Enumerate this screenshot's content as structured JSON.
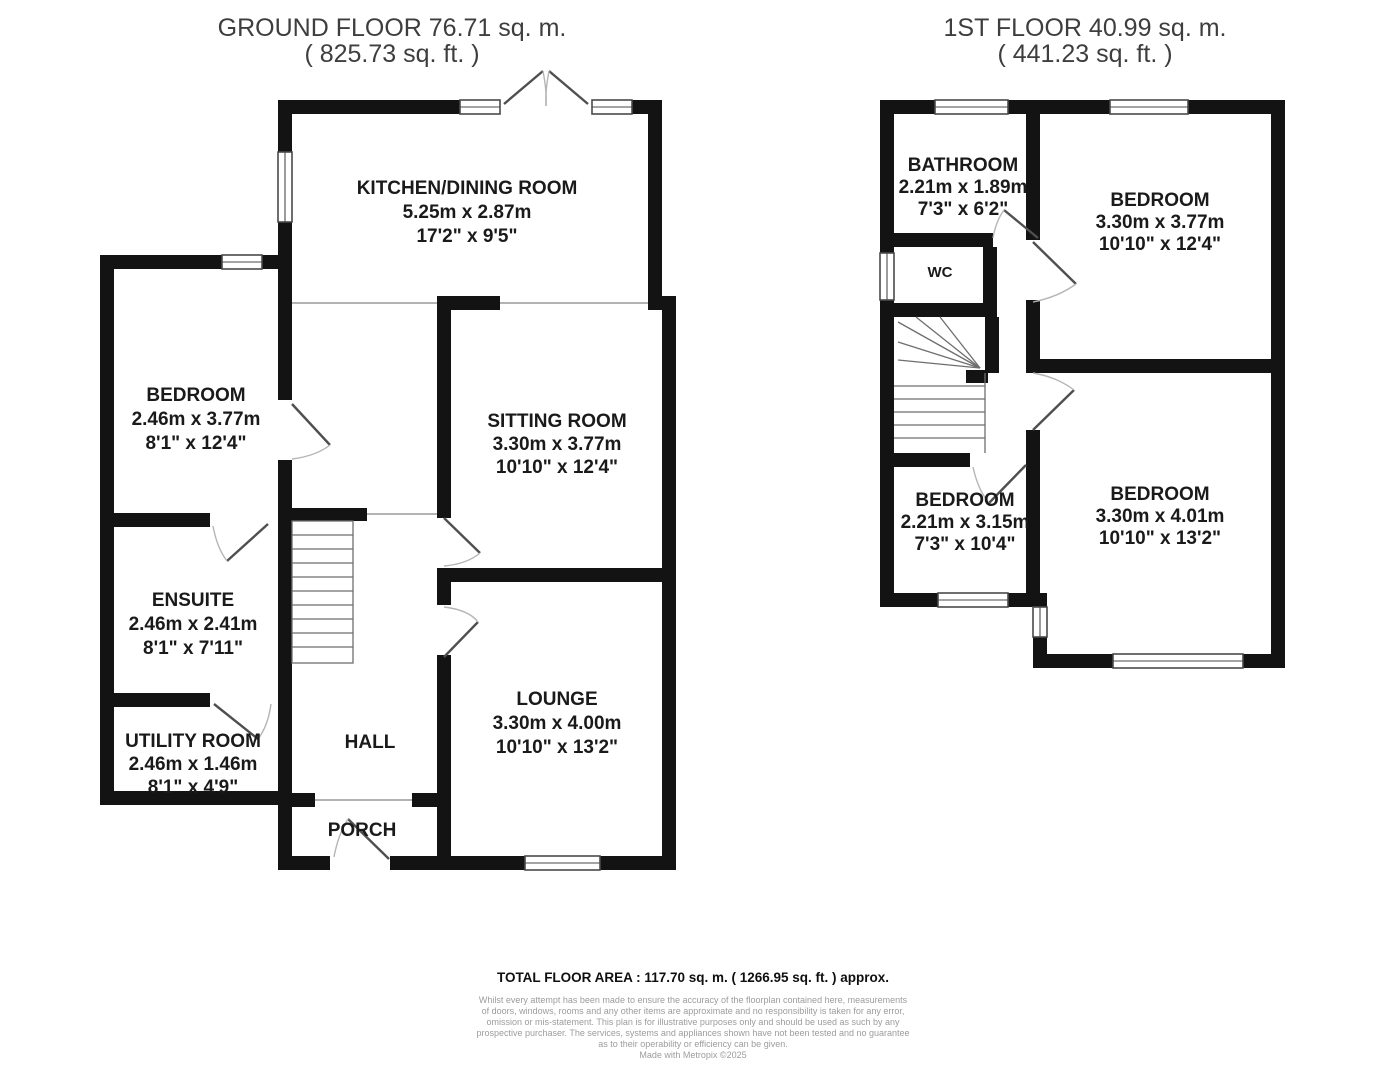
{
  "ground_floor": {
    "title": "GROUND FLOOR 76.71 sq. m.",
    "subtitle": "( 825.73 sq. ft. )",
    "rooms": {
      "kitchen": {
        "name": "KITCHEN/DINING ROOM",
        "metric": "5.25m x 2.87m",
        "imperial": "17'2\" x 9'5\""
      },
      "bedroom": {
        "name": "BEDROOM",
        "metric": "2.46m x 3.77m",
        "imperial": "8'1\" x 12'4\""
      },
      "sitting": {
        "name": "SITTING ROOM",
        "metric": "3.30m x 3.77m",
        "imperial": "10'10\" x 12'4\""
      },
      "ensuite": {
        "name": "ENSUITE",
        "metric": "2.46m x 2.41m",
        "imperial": "8'1\" x 7'11\""
      },
      "utility": {
        "name": "UTILITY ROOM",
        "metric": "2.46m x 1.46m",
        "imperial": "8'1\" x 4'9\""
      },
      "hall": {
        "name": "HALL"
      },
      "lounge": {
        "name": "LOUNGE",
        "metric": "3.30m x 4.00m",
        "imperial": "10'10\" x 13'2\""
      },
      "porch": {
        "name": "PORCH"
      }
    }
  },
  "first_floor": {
    "title": "1ST FLOOR 40.99 sq. m.",
    "subtitle": "( 441.23 sq. ft. )",
    "rooms": {
      "bathroom": {
        "name": "BATHROOM",
        "metric": "2.21m x 1.89m",
        "imperial": "7'3\" x 6'2\""
      },
      "wc": {
        "name": "WC"
      },
      "bedroom_right_top": {
        "name": "BEDROOM",
        "metric": "3.30m x 3.77m",
        "imperial": "10'10\" x 12'4\""
      },
      "bedroom_left": {
        "name": "BEDROOM",
        "metric": "2.21m x 3.15m",
        "imperial": "7'3\" x 10'4\""
      },
      "bedroom_right_bottom": {
        "name": "BEDROOM",
        "metric": "3.30m x 4.01m",
        "imperial": "10'10\" x 13'2\""
      }
    }
  },
  "footer": {
    "total_area": "TOTAL FLOOR AREA : 117.70 sq. m. ( 1266.95 sq. ft. ) approx.",
    "disclaimer": [
      "Whilst every attempt has been made to ensure the accuracy of the floorplan contained here, measurements",
      "of doors, windows, rooms and any other items are approximate and no responsibility is taken for any error,",
      "omission or mis-statement. This plan is for illustrative purposes only and should be used as such by any",
      "prospective purchaser. The services, systems and appliances shown have not been tested and no guarantee",
      "as to their operability or efficiency can be given.",
      "Made with Metropix ©2025"
    ]
  }
}
